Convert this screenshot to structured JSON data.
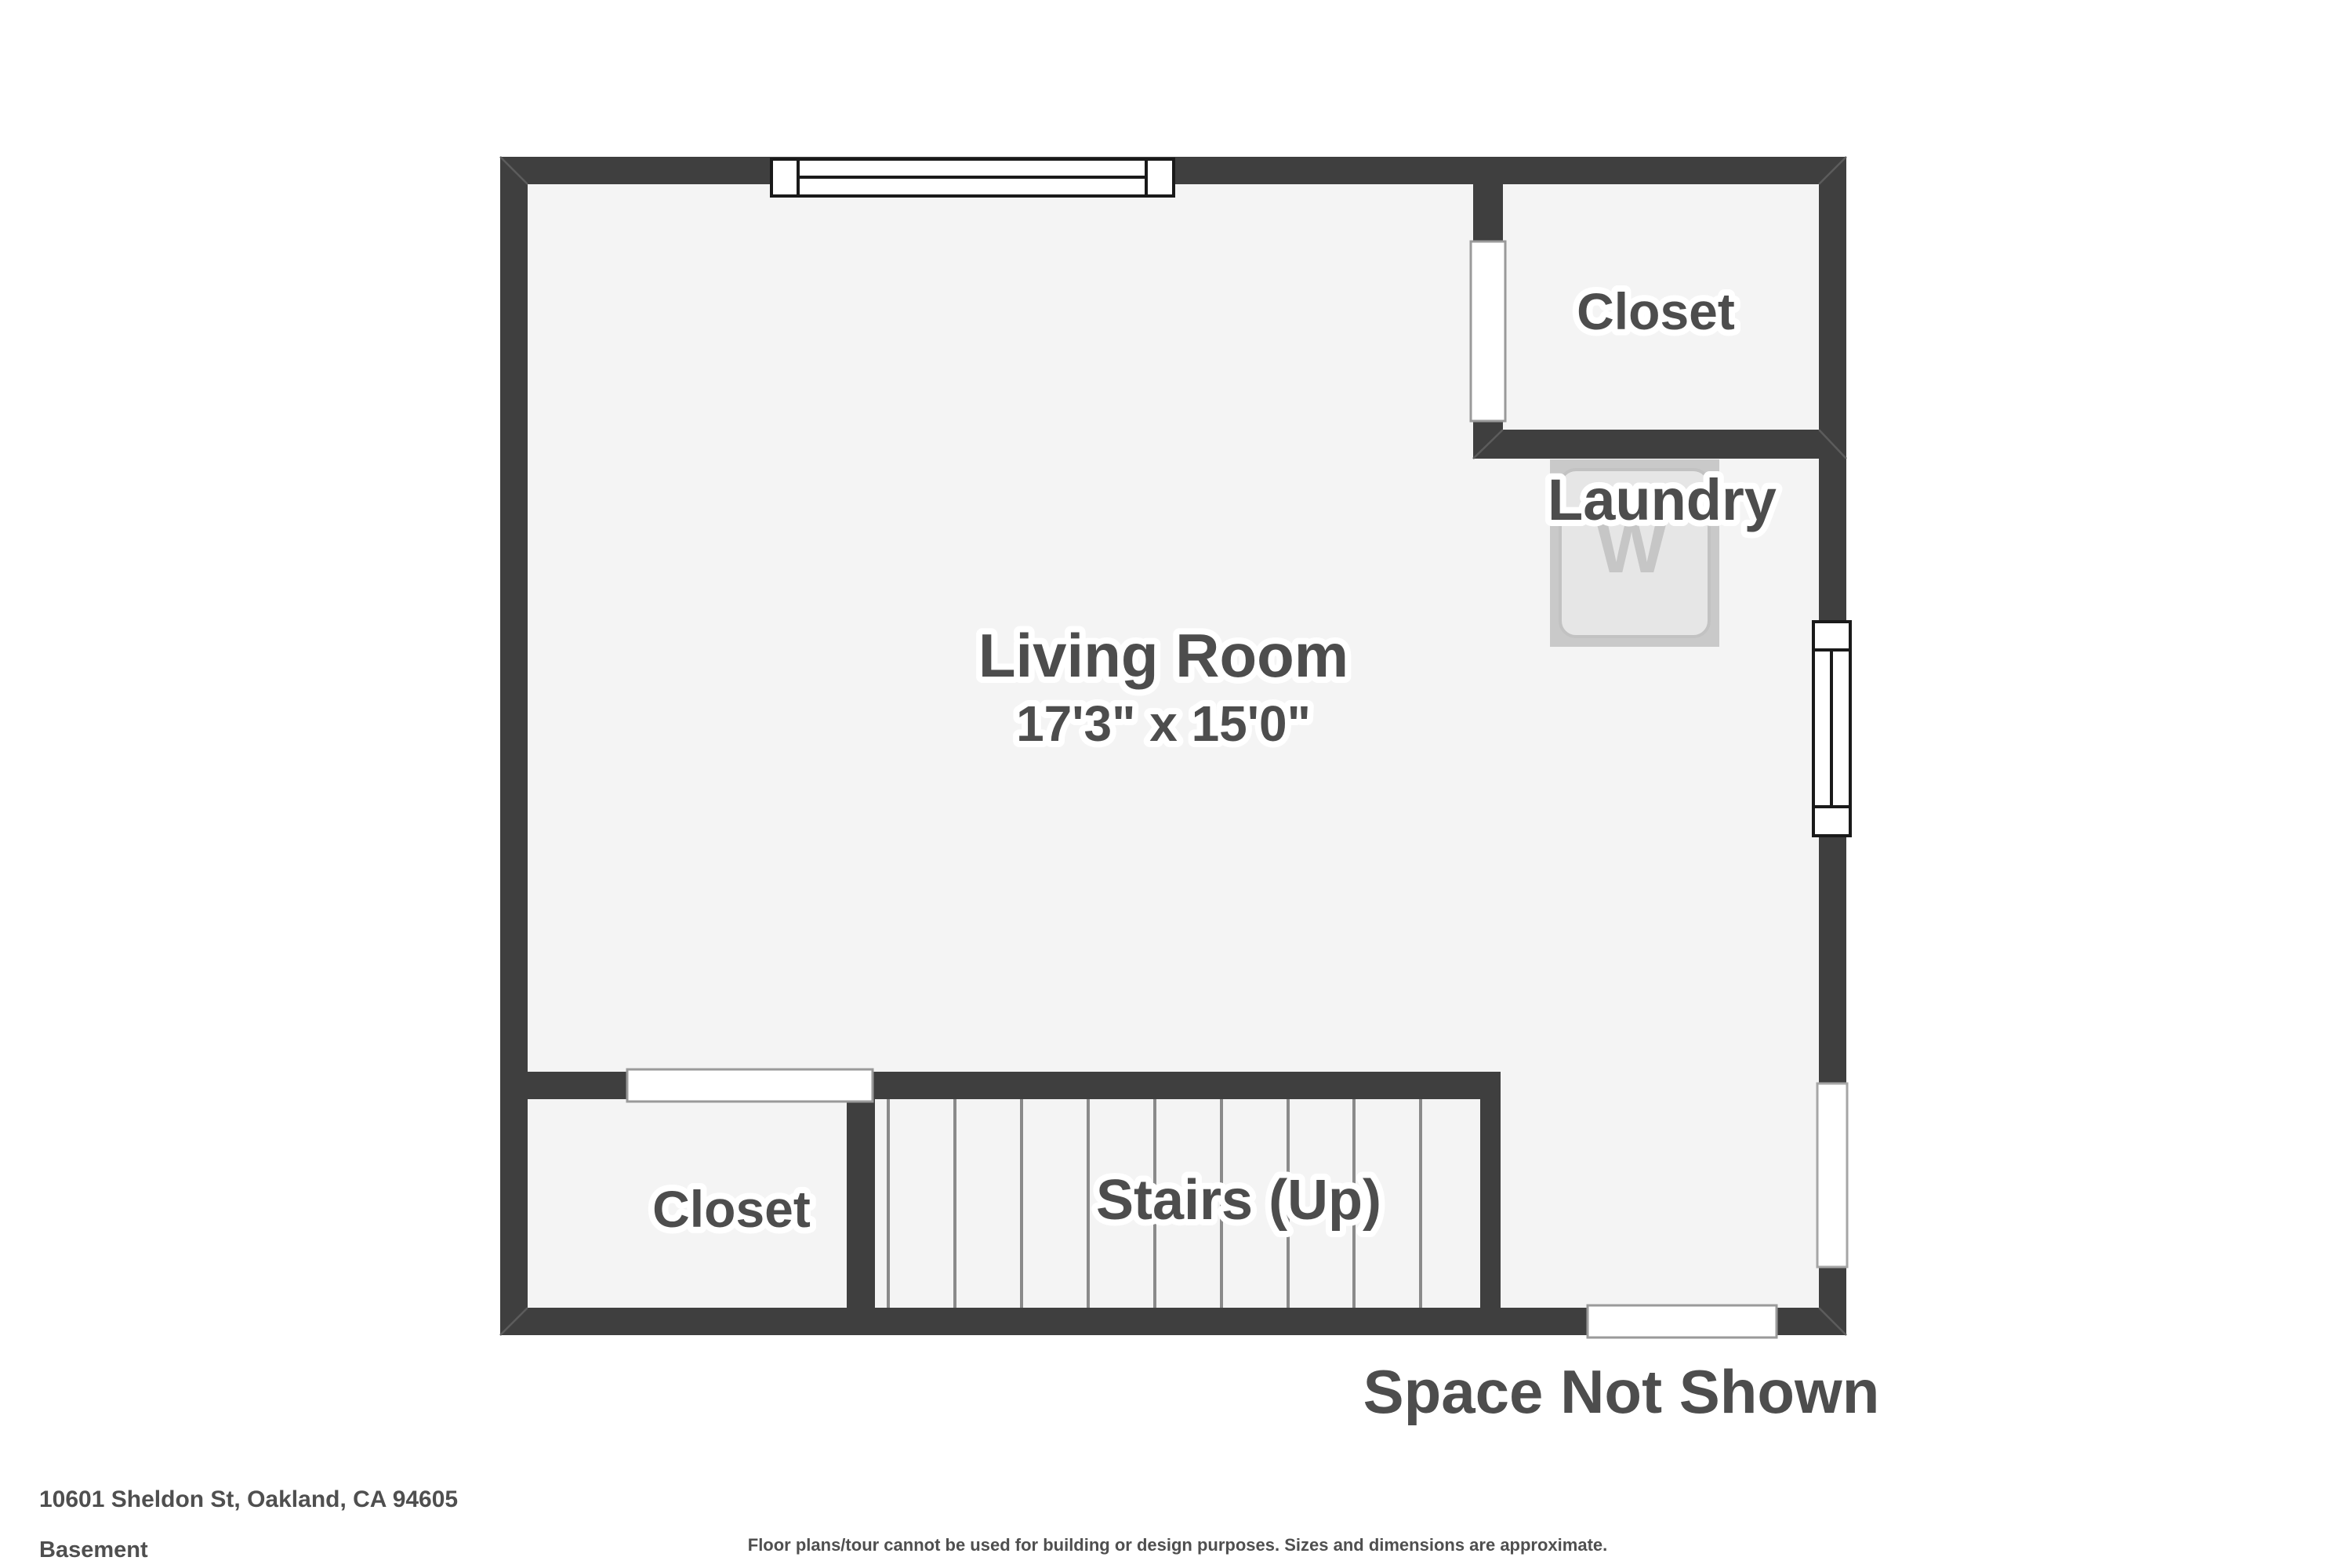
{
  "page": {
    "address": "10601 Sheldon St, Oakland, CA 94605",
    "level": "Basement",
    "disclaimer": "Floor plans/tour cannot be used for building or design purposes. Sizes and dimensions are approximate."
  },
  "floor_plan": {
    "rooms": {
      "living_room": {
        "label": "Living Room",
        "dimensions": "17'3\" x 15'0\""
      },
      "closet_top_right": {
        "label": "Closet"
      },
      "closet_bottom_left": {
        "label": "Closet"
      },
      "laundry": {
        "label": "Laundry",
        "washer_letter": "W"
      },
      "stairs": {
        "label": "Stairs (Up)"
      }
    },
    "annotations": {
      "space_not_shown": "Space Not Shown"
    },
    "features": {
      "windows": [
        "top-wall-window",
        "right-wall-window-upper",
        "right-wall-window-lower"
      ],
      "door_openings": [
        "closet-top-right-opening",
        "closet-bottom-left-opening",
        "bottom-wall-exit-opening"
      ],
      "stair_tread_count": 10
    },
    "colors": {
      "wall": "#3f3f3f",
      "floor": "#f4f4f4",
      "label_text": "#4d4d4d",
      "label_halo": "#ffffff",
      "window_border": "#1a1a1a",
      "opening_border": "#9a9a9a",
      "tread_line": "#8a8a8a",
      "washer_outer": "#c9c9c9",
      "washer_inner": "#e6e6e6",
      "washer_letter": "#c6c6c6",
      "footer_text": "#4f4f4f"
    }
  }
}
